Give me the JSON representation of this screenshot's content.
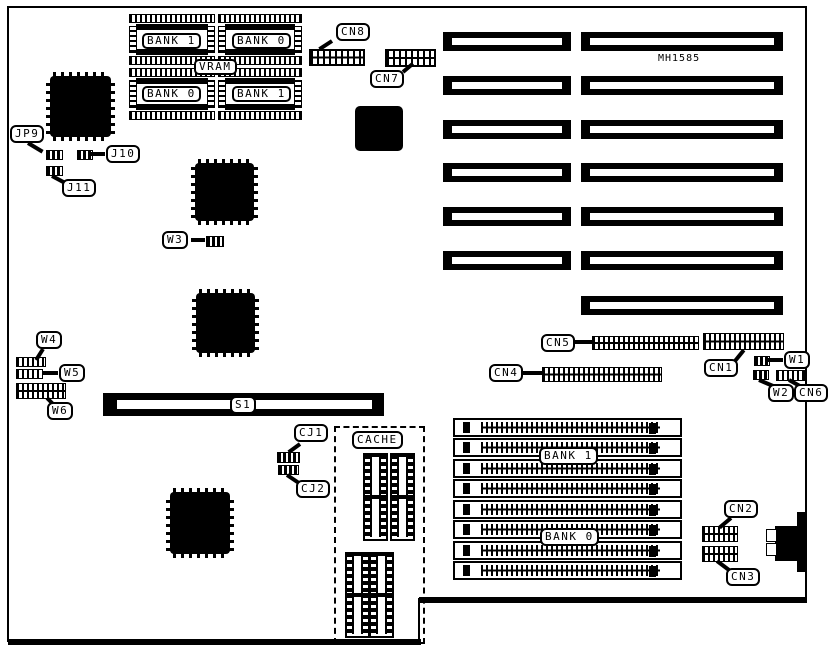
{
  "board": {
    "model": "MH1585"
  },
  "vram": {
    "label": "VRAM",
    "bank_top_left": "BANK 1",
    "bank_top_right": "BANK 0",
    "bank_bottom_left": "BANK 0",
    "bank_bottom_right": "BANK 1"
  },
  "memory": {
    "bank_upper": "BANK 1",
    "bank_lower": "BANK 0"
  },
  "cache": {
    "label": "CACHE"
  },
  "slot": {
    "s1": "S1"
  },
  "connectors": {
    "cn1": "CN1",
    "cn2": "CN2",
    "cn3": "CN3",
    "cn4": "CN4",
    "cn5": "CN5",
    "cn6": "CN6",
    "cn7": "CN7",
    "cn8": "CN8"
  },
  "jumpers": {
    "jp9": "JP9",
    "j10": "J10",
    "j11": "J11",
    "w1": "W1",
    "w2": "W2",
    "w3": "W3",
    "w4": "W4",
    "w5": "W5",
    "w6": "W6",
    "cj1": "CJ1",
    "cj2": "CJ2"
  }
}
